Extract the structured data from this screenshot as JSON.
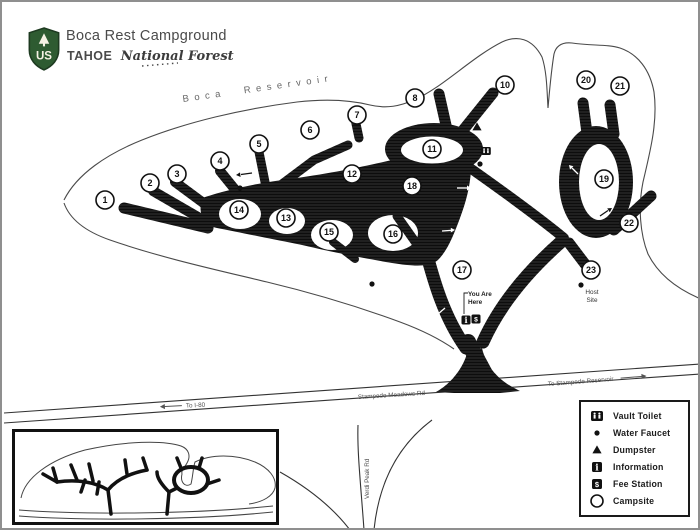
{
  "header": {
    "title": "Boca Rest Campground",
    "forest_prefix": "TAHOE",
    "forest_name": "National Forest",
    "logo": "us-forest-service-shield",
    "logo_text": "US"
  },
  "map": {
    "water_label": "Boca Reservoir",
    "roads": {
      "stampede": "Stampede Meadows Rd",
      "to_reservoir": "To Stampede Reservoir",
      "to_i80": "To I-80",
      "verdi": "Verdi Peak Rd"
    },
    "you_are_here": {
      "line1": "You Are",
      "line2": "Here"
    },
    "host_site": {
      "line1": "Host",
      "line2": "Site"
    },
    "sites": [
      {
        "n": "1",
        "x": 103,
        "y": 198
      },
      {
        "n": "2",
        "x": 148,
        "y": 181
      },
      {
        "n": "3",
        "x": 175,
        "y": 172
      },
      {
        "n": "4",
        "x": 218,
        "y": 159
      },
      {
        "n": "5",
        "x": 257,
        "y": 142
      },
      {
        "n": "6",
        "x": 308,
        "y": 128
      },
      {
        "n": "7",
        "x": 355,
        "y": 113
      },
      {
        "n": "8",
        "x": 413,
        "y": 96
      },
      {
        "n": "10",
        "x": 503,
        "y": 83
      },
      {
        "n": "11",
        "x": 430,
        "y": 147
      },
      {
        "n": "12",
        "x": 350,
        "y": 172
      },
      {
        "n": "13",
        "x": 284,
        "y": 216
      },
      {
        "n": "14",
        "x": 237,
        "y": 208
      },
      {
        "n": "15",
        "x": 327,
        "y": 230
      },
      {
        "n": "16",
        "x": 391,
        "y": 232
      },
      {
        "n": "17",
        "x": 460,
        "y": 268
      },
      {
        "n": "18",
        "x": 410,
        "y": 184
      },
      {
        "n": "19",
        "x": 602,
        "y": 177
      },
      {
        "n": "20",
        "x": 584,
        "y": 78
      },
      {
        "n": "21",
        "x": 618,
        "y": 84
      },
      {
        "n": "22",
        "x": 627,
        "y": 221
      },
      {
        "n": "23",
        "x": 589,
        "y": 268
      }
    ],
    "amenities": [
      {
        "type": "vault-toilet",
        "x": 484,
        "y": 149
      },
      {
        "type": "water-faucet",
        "x": 238,
        "y": 186
      },
      {
        "type": "water-faucet",
        "x": 478,
        "y": 162
      },
      {
        "type": "water-faucet",
        "x": 370,
        "y": 282
      },
      {
        "type": "water-faucet",
        "x": 579,
        "y": 283
      },
      {
        "type": "dumpster",
        "x": 475,
        "y": 125
      },
      {
        "type": "information",
        "x": 464,
        "y": 318
      },
      {
        "type": "fee-station",
        "x": 474,
        "y": 317
      }
    ]
  },
  "legend": {
    "items": [
      {
        "icon": "vault-toilet",
        "label": "Vault Toilet"
      },
      {
        "icon": "water-faucet",
        "label": "Water Faucet"
      },
      {
        "icon": "dumpster",
        "label": "Dumpster"
      },
      {
        "icon": "information",
        "label": "Information"
      },
      {
        "icon": "fee-station",
        "label": "Fee Station"
      },
      {
        "icon": "campsite",
        "label": "Campsite"
      }
    ]
  }
}
